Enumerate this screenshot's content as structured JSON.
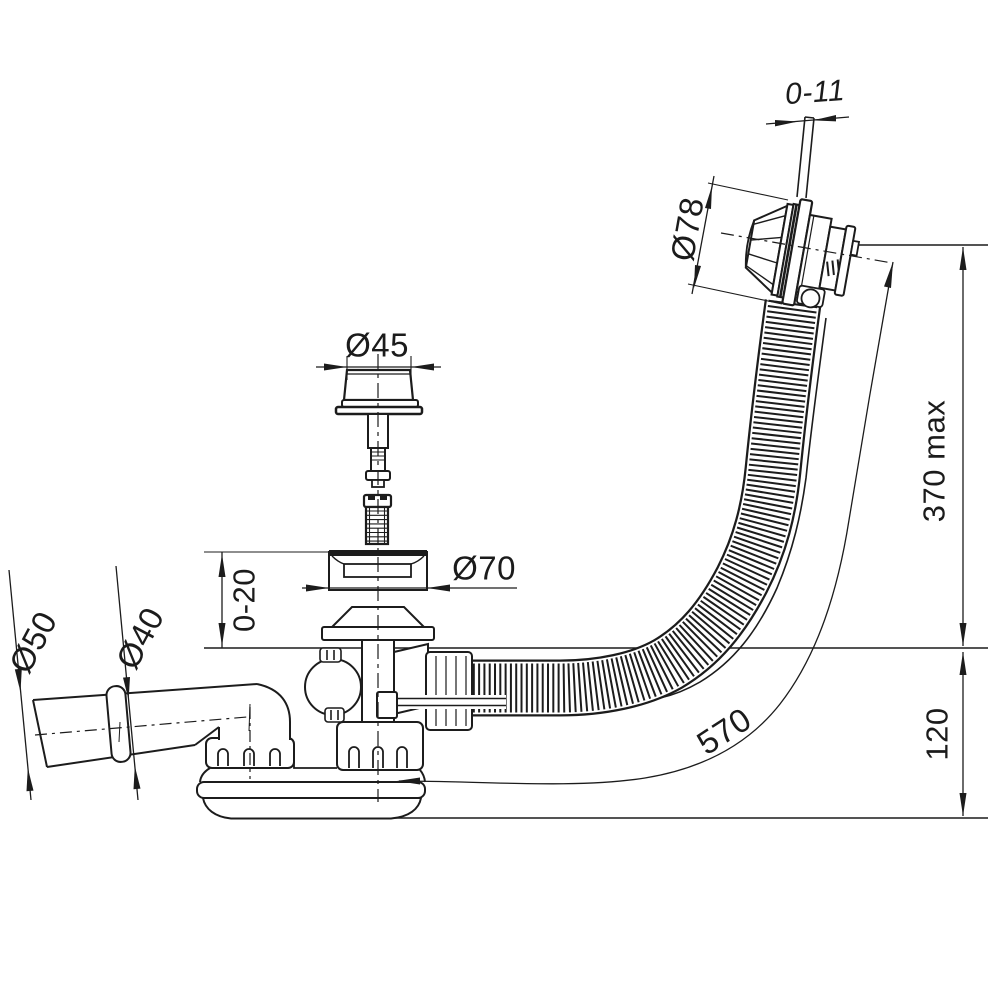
{
  "meta": {
    "type": "technical-drawing",
    "subject": "Bath waste, overflow and trap assembly – dimensioned side view"
  },
  "colors": {
    "background": "#ffffff",
    "line": "#1c1c1c"
  },
  "dimensions": {
    "rod_adjust": "0-11",
    "overflow_head_diameter": "Ø78",
    "plug_diameter": "Ø45",
    "flange_diameter": "Ø70",
    "flange_height_range": "0-20",
    "outlet_sleeve_diameter": "Ø50",
    "outlet_pipe_diameter": "Ø40",
    "overflow_height": "370 max",
    "trap_height": "120",
    "hose_length": "570"
  }
}
